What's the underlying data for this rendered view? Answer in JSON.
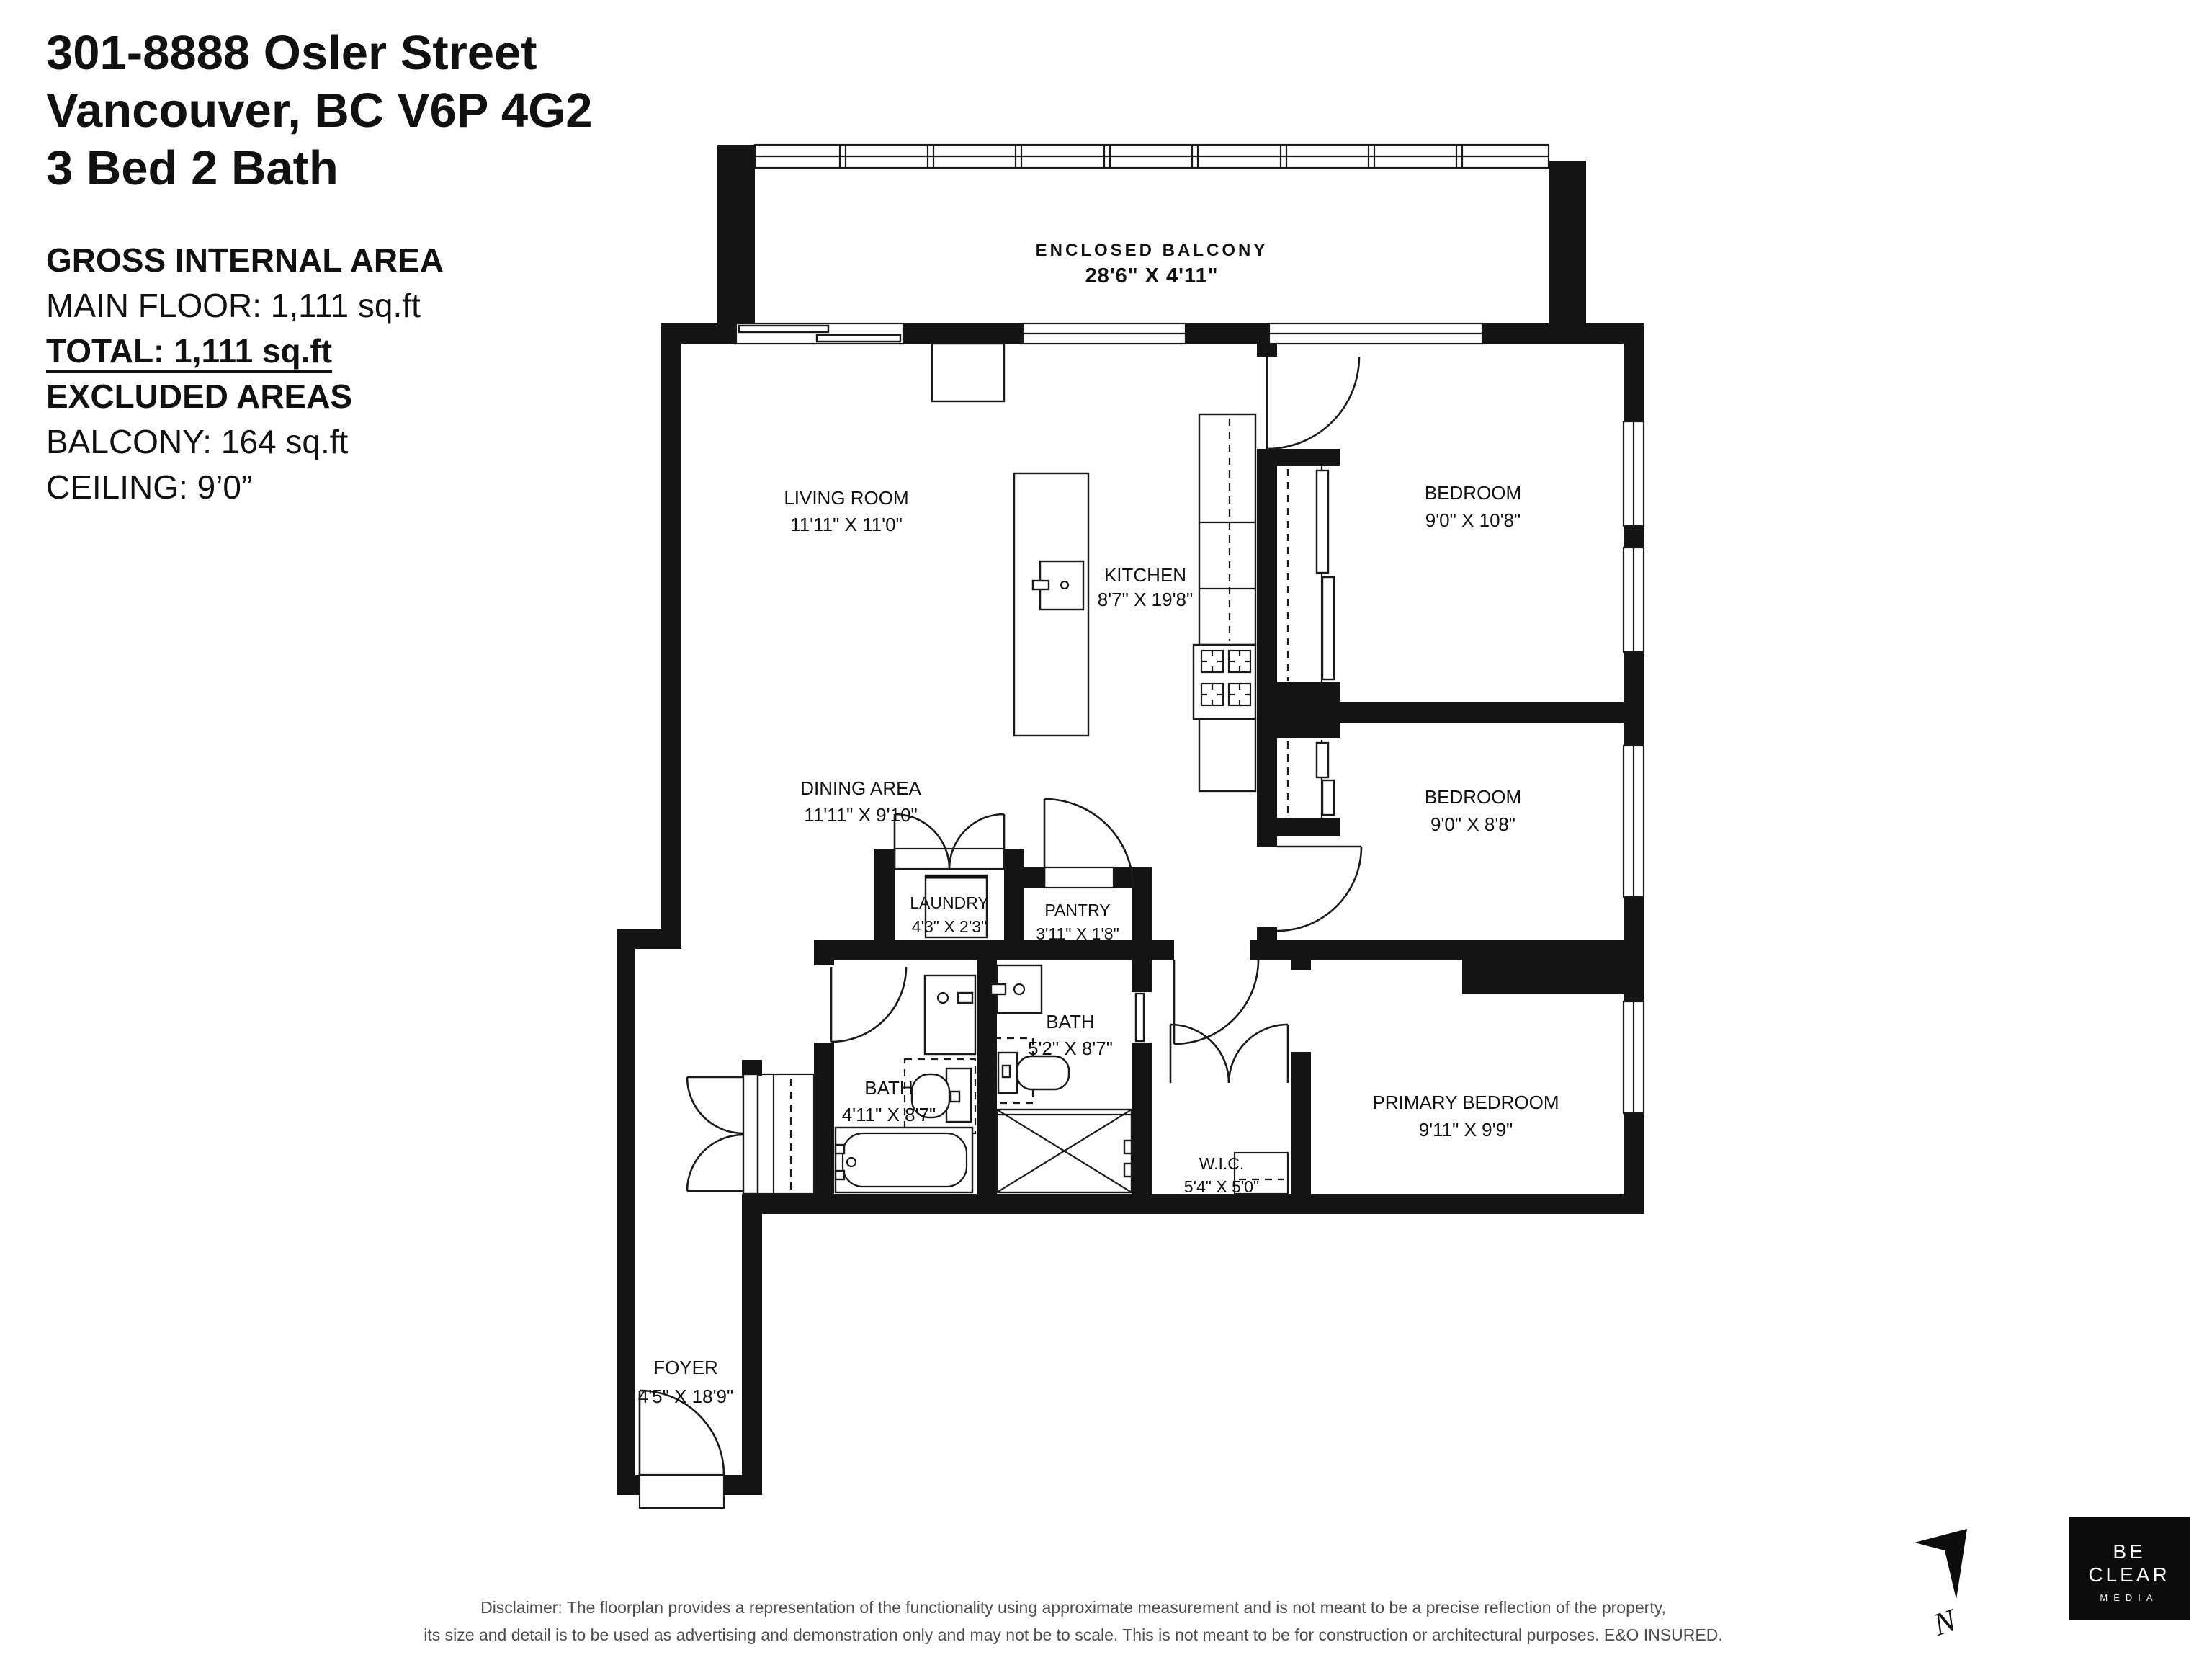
{
  "header": {
    "address_line1": "301-8888 Osler Street",
    "address_line2": "Vancouver, BC V6P 4G2",
    "address_line3": "3 Bed 2 Bath"
  },
  "area_summary": {
    "gross_title": "GROSS INTERNAL AREA",
    "main_floor": "MAIN FLOOR: 1,111 sq.ft",
    "total": "TOTAL: 1,111 sq.ft",
    "excluded_title": "EXCLUDED AREAS",
    "balcony": "BALCONY: 164 sq.ft",
    "ceiling": "CEILING: 9’0”"
  },
  "rooms": [
    {
      "id": "enclosed-balcony",
      "name": "ENCLOSED BALCONY",
      "dims": "28'6\" X 4'11\""
    },
    {
      "id": "living-room",
      "name": "LIVING ROOM",
      "dims": "11'11\" X 11'0\""
    },
    {
      "id": "kitchen",
      "name": "KITCHEN",
      "dims": "8'7\" X 19'8\""
    },
    {
      "id": "dining-area",
      "name": "DINING AREA",
      "dims": "11'11\" X 9'10\""
    },
    {
      "id": "bedroom-1",
      "name": "BEDROOM",
      "dims": "9'0\" X 10'8\""
    },
    {
      "id": "bedroom-2",
      "name": "BEDROOM",
      "dims": "9'0\" X 8'8\""
    },
    {
      "id": "laundry",
      "name": "LAUNDRY",
      "dims": "4'3\" X 2'3\""
    },
    {
      "id": "pantry",
      "name": "PANTRY",
      "dims": "3'11\" X 1'8\""
    },
    {
      "id": "bath-main",
      "name": "BATH",
      "dims": "4'11\" X 8'7\""
    },
    {
      "id": "bath-2",
      "name": "BATH",
      "dims": "5'2\" X 8'7\""
    },
    {
      "id": "wic",
      "name": "W.I.C.",
      "dims": "5'4\" X 5'0\""
    },
    {
      "id": "primary-bedroom",
      "name": "PRIMARY BEDROOM",
      "dims": "9'11\" X 9'9\""
    },
    {
      "id": "foyer",
      "name": "FOYER",
      "dims": "4'5\" X 18'9\""
    }
  ],
  "footer": {
    "disclaimer_line1": "Disclaimer: The floorplan provides a representation of the functionality using approximate measurement and is not meant to be a precise reflection of the property,",
    "disclaimer_line2": "its size and detail is to be used as advertising and demonstration only and may not be to scale. This is not meant to be for construction or architectural purposes. E&O INSURED."
  },
  "logo": {
    "line1": "BE CLEAR",
    "line2": "MEDIA"
  },
  "compass": {
    "label": "N"
  },
  "colors": {
    "wall": "#141414",
    "paper": "#ffffff",
    "muted_text": "#4d4d4d"
  }
}
